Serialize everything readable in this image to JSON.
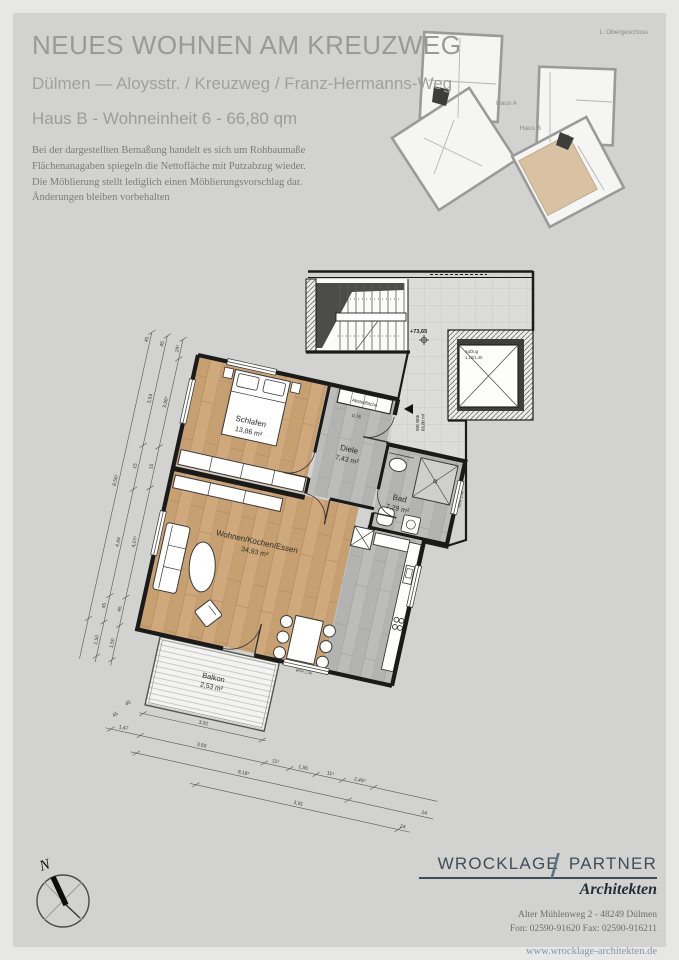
{
  "header": {
    "title": "NEUES WOHNEN AM KREUZWEG",
    "subtitle": "Dülmen  —  Aloysstr. / Kreuzweg / Franz-Hermanns-Weg",
    "unit_line": "Haus B - Wohneinheit 6 - 66,80 qm",
    "disclaimer_lines": [
      "Bei der dargestellten Bemaßung handelt es sich um Rohbaumaße",
      "Flächenanagaben spiegeln die Nettofläche mit Putzabzug wieder.",
      "Die Möblierung stellt  lediglich einen Möblierungsvorschlag dar.",
      "Änderungen bleiben vorbehalten"
    ]
  },
  "overview": {
    "floor_label": "1. Obergeschoss",
    "haus_a": "Haus A",
    "haus_b": "Haus B",
    "highlight_color": "#d9c2a2"
  },
  "plan": {
    "rooms": [
      {
        "name": "Schlafen",
        "area": "13,86 m²"
      },
      {
        "name": "Diele",
        "area": "7,43 m²"
      },
      {
        "name": "Bad",
        "area": "7,29 m²"
      },
      {
        "name": "Wohnen/Kochen/Essen",
        "area": "34,93 m²"
      },
      {
        "name": "Balkon",
        "area": "2,53 m²"
      },
      {
        "name": "Abstellfläche",
        "area": "0,76"
      }
    ],
    "level_marker": "+73,65",
    "unit_tag": {
      "line1": "WE B06",
      "line2": "66,80 m²"
    },
    "elevator": {
      "line1": "Aufzug",
      "line2": "1,10/1,40"
    },
    "brh_labels": [
      "BRH 1,36",
      "BRH 1,35"
    ],
    "dims_left": [
      "24⁵",
      "3,96⁵",
      "15",
      "4,07⁵",
      "45",
      "1,50",
      "45",
      "3,54",
      "15",
      "4,44",
      "45",
      "1,50",
      "45",
      "8,56⁵"
    ],
    "dims_bottom": [
      "3,91",
      "45",
      "45",
      "1,47",
      "3,50",
      "11⁵",
      "1,55",
      "11⁵",
      "2,49⁵",
      "8,18⁵",
      "24",
      "3,91",
      "24"
    ],
    "colors": {
      "wood": "#cfa87b",
      "gray_floor": "#b9b9b7",
      "tile": "#dcdcda"
    }
  },
  "compass": {
    "north": "N"
  },
  "logo": {
    "name1": "WROCKLAGE",
    "slash": "/",
    "name2": "PARTNER",
    "sub": "Architekten",
    "address": "Alter Mühlenweg 2 - 48249 Dülmen",
    "phone": "Fon: 02590-91620 Fax: 02590-916211",
    "web": "www.wrocklage-architekten.de"
  }
}
